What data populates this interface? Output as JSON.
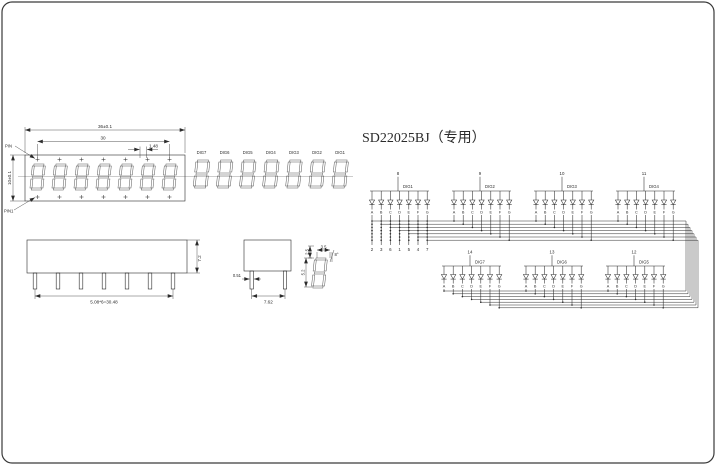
{
  "title": "SD22025BJ（专用）",
  "face_view": {
    "dim_total_width": "36±0.1",
    "dim_inner_width": "30",
    "dim_dp_offset": "1.48",
    "dim_height": "10±0.1",
    "callout_top": "PIN",
    "callout_bottom": "PIN1"
  },
  "digit_row": {
    "labels": [
      "DIG7",
      "DIG6",
      "DIG5",
      "DIG4",
      "DIG3",
      "DIG2",
      "DIG1"
    ]
  },
  "side_view": {
    "dim_height": "7.2",
    "dim_pin_span": "5.08*6=30.48"
  },
  "end_view": {
    "dim_pin_width": "0.51",
    "dim_body_width": "7.62"
  },
  "glyph_detail": {
    "dim_top_offset": "2.5",
    "dim_width": "3.5",
    "dim_height": "5.2",
    "dim_slant": "8°"
  },
  "schematic": {
    "segment_letters": [
      "A",
      "B",
      "C",
      "D",
      "E",
      "F",
      "G"
    ],
    "segment_pins": [
      "2",
      "3",
      "6",
      "1",
      "5",
      "4",
      "7"
    ],
    "top_groups": [
      {
        "pin": "8",
        "label": "DIG1"
      },
      {
        "pin": "9",
        "label": "DIG2"
      },
      {
        "pin": "10",
        "label": "DIG3"
      },
      {
        "pin": "11",
        "label": "DIG4"
      }
    ],
    "bottom_groups": [
      {
        "pin": "14",
        "label": "DIG7"
      },
      {
        "pin": "13",
        "label": "DIG6"
      },
      {
        "pin": "12",
        "label": "DIG5"
      }
    ]
  },
  "colors": {
    "line": "#2b2b2b",
    "segment": "#555555",
    "background": "#ffffff"
  }
}
